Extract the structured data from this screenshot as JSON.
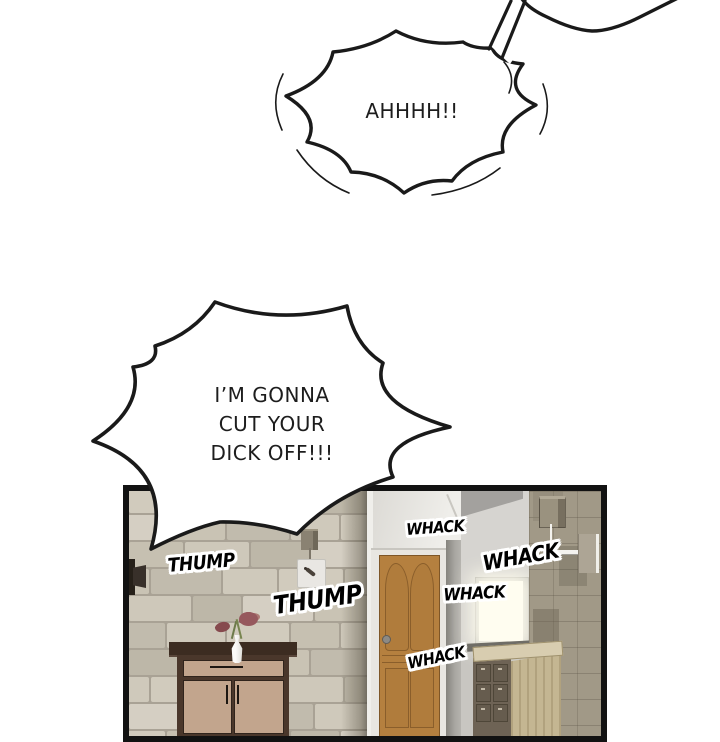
{
  "bubbles": {
    "scream": {
      "text": "AHHHH!!"
    },
    "threat": {
      "lines": [
        "I’M GONNA",
        "CUT YOUR",
        "DICK OFF!!!"
      ]
    }
  },
  "sfx": [
    {
      "id": "thump-1",
      "text": "THUMP"
    },
    {
      "id": "thump-2",
      "text": "THUMP"
    },
    {
      "id": "whack-1",
      "text": "WHACK"
    },
    {
      "id": "whack-2",
      "text": "WHACK"
    },
    {
      "id": "whack-3",
      "text": "WHACK"
    },
    {
      "id": "whack-4",
      "text": "WHACK"
    }
  ],
  "colors": {
    "background": "#ffffff",
    "ink": "#1a1a1a",
    "panel_border": "#121212",
    "stone_mortar": "#a9a295",
    "door_wood": "#b5803f",
    "door_frame": "#e8e6e1",
    "inner_wall": "#d6d4d0",
    "tile_wall": "#a19987",
    "window_glow": "#fffdf0",
    "cabinet_dark": "#4a372b",
    "cabinet_panel": "#c2a58d",
    "dresser_wood": "#c4b692",
    "dresser_drawers": "#6e6355",
    "sfx_fill": "#000000",
    "sfx_outline": "#ffffff"
  }
}
